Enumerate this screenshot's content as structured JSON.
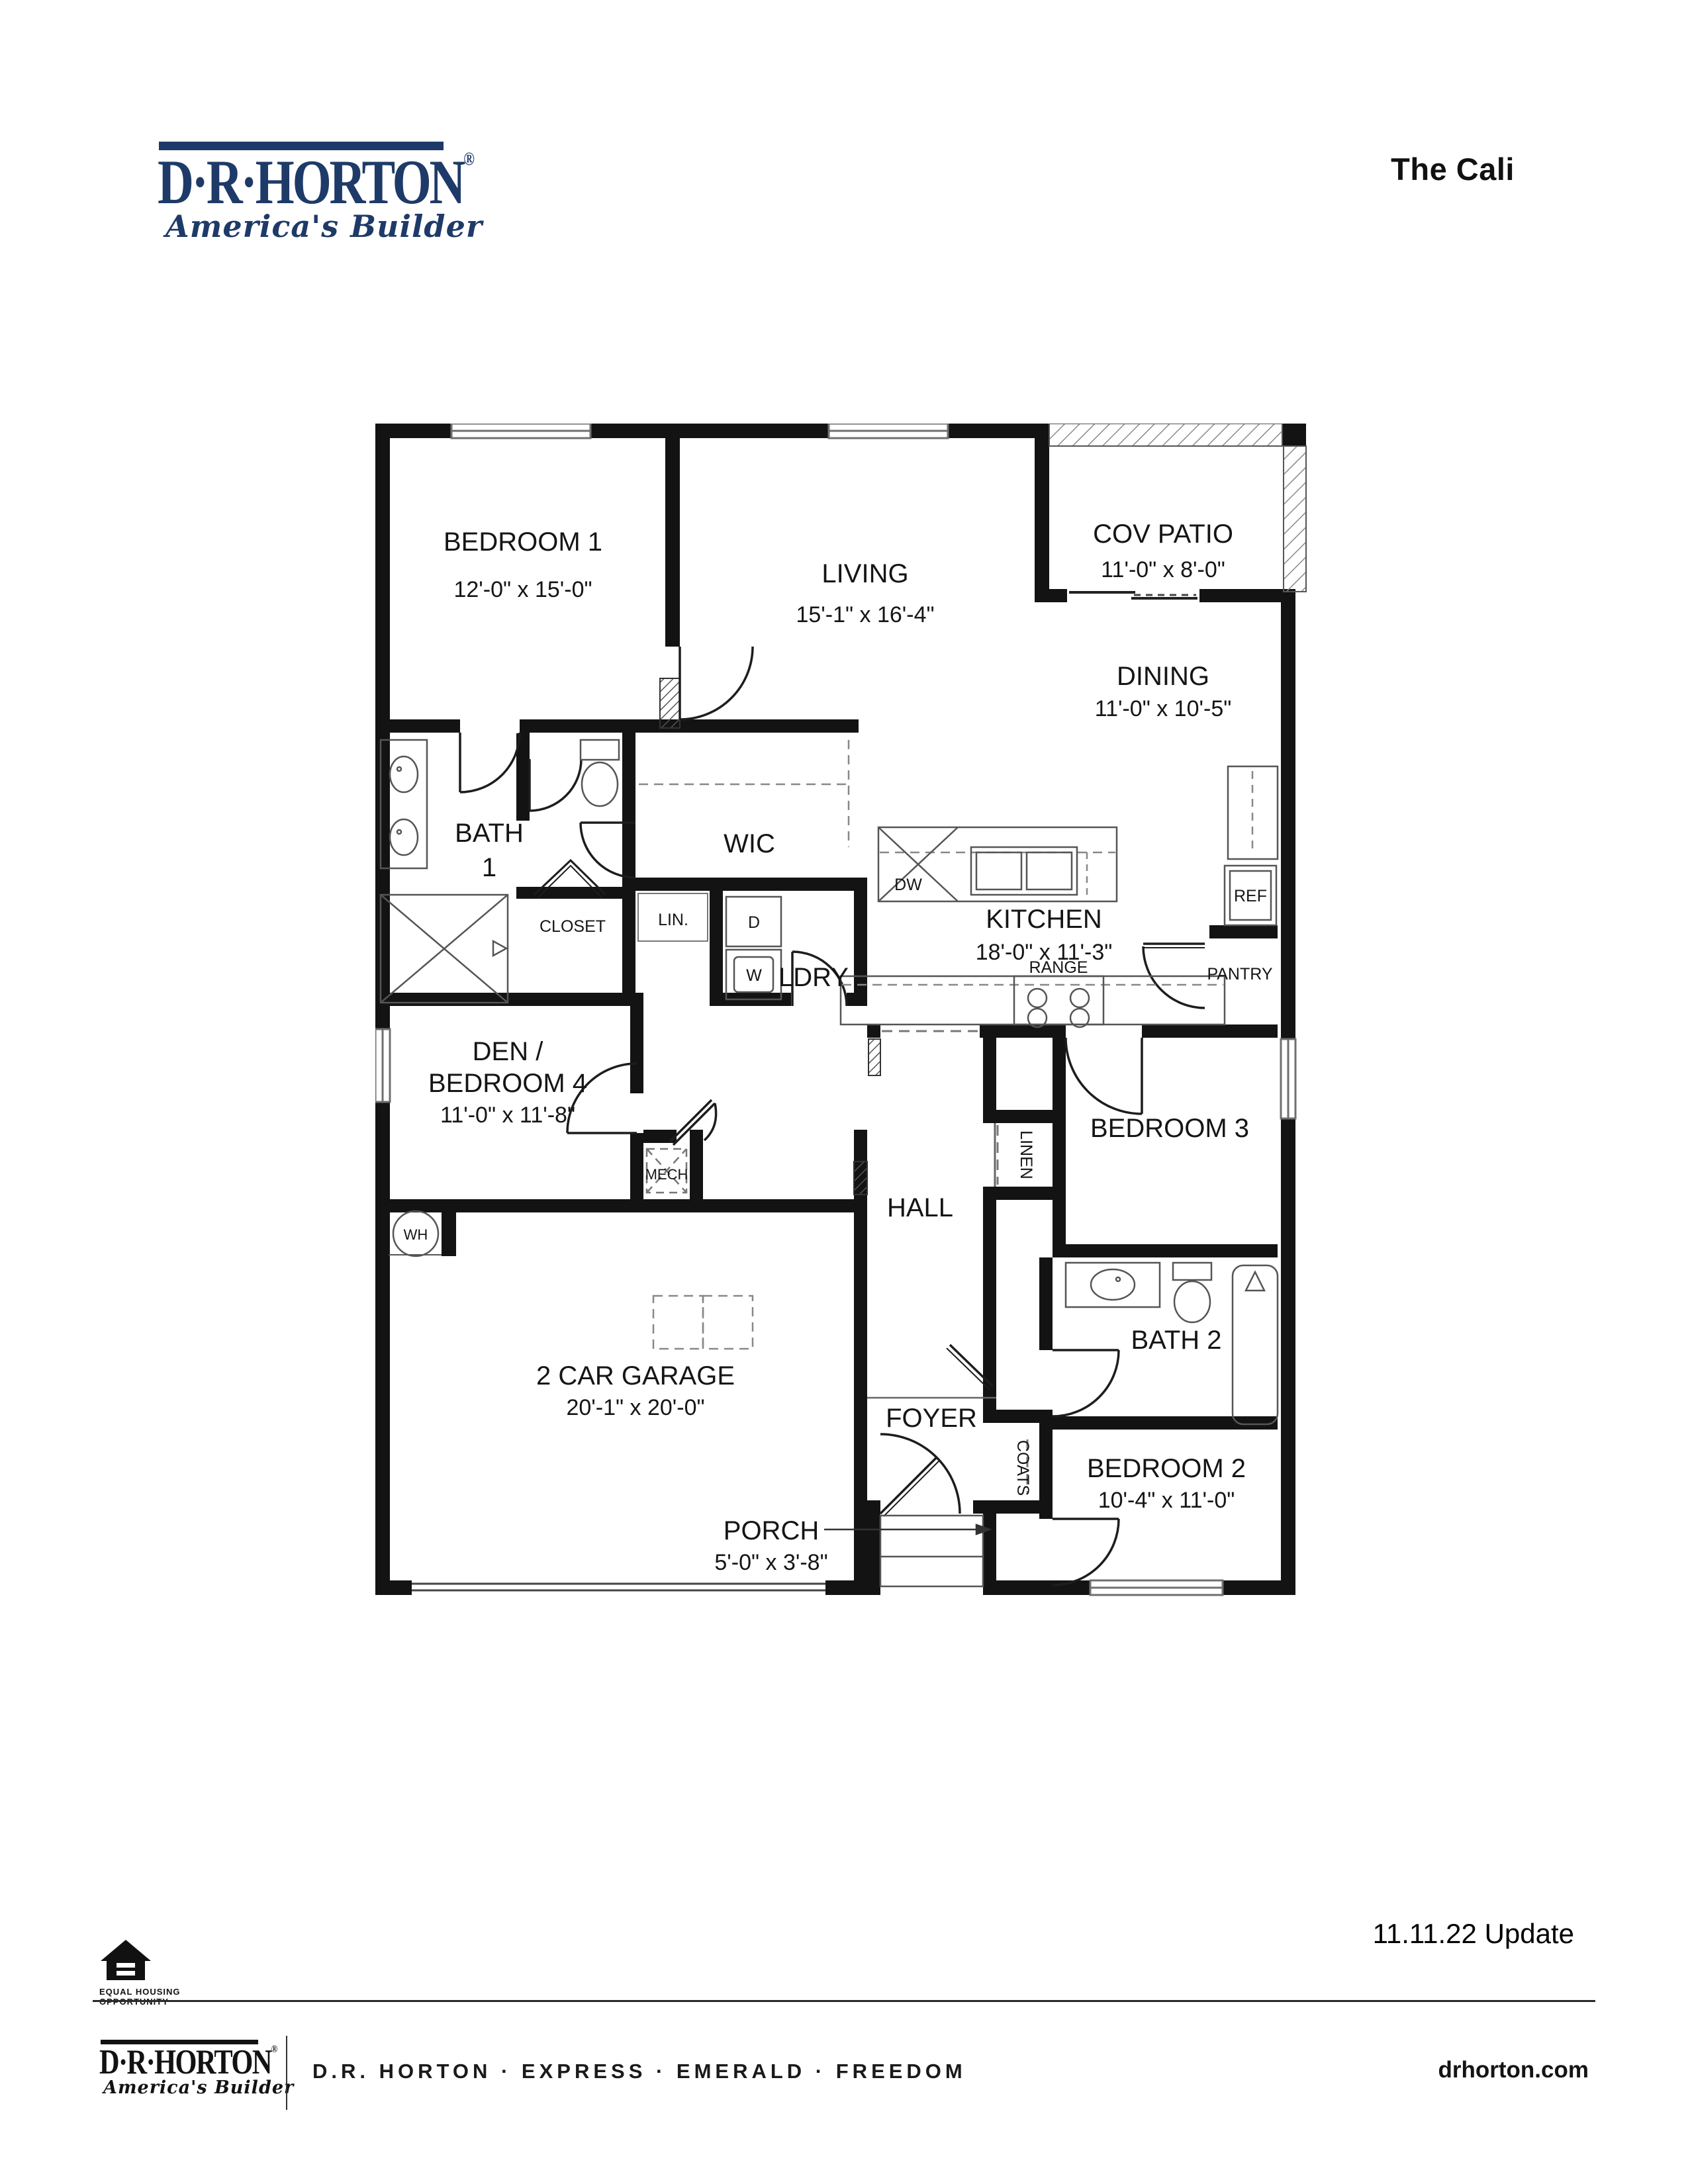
{
  "header": {
    "brand": {
      "name": "D·R·HORTON",
      "reg": "®",
      "tagline": "America's Builder"
    },
    "plan_title": "The Cali"
  },
  "plan": {
    "rooms": {
      "bedroom1": {
        "name": "BEDROOM 1",
        "dims": "12'-0\" x 15'-0\""
      },
      "living": {
        "name": "LIVING",
        "dims": "15'-1\" x 16'-4\""
      },
      "cov_patio": {
        "name": "COV PATIO",
        "dims": "11'-0\" x 8'-0\""
      },
      "dining": {
        "name": "DINING",
        "dims": "11'-0\" x 10'-5\""
      },
      "bath1": {
        "name": "BATH",
        "number": "1"
      },
      "wic": {
        "name": "WIC"
      },
      "closet": {
        "name": "CLOSET"
      },
      "ldry": {
        "name": "LDRY"
      },
      "kitchen": {
        "name": "KITCHEN",
        "dims": "18'-0\" x 11'-3\""
      },
      "den": {
        "line1": "DEN /",
        "line2": "BEDROOM 4",
        "dims": "11'-0\" x 11'-8\""
      },
      "hall": {
        "name": "HALL"
      },
      "bedroom3": {
        "name": "BEDROOM 3",
        "dims": "10'-4\" x 11'-0\""
      },
      "garage": {
        "name": "2 CAR GARAGE",
        "dims": "20'-1\" x 20'-0\""
      },
      "bath2": {
        "name": "BATH 2"
      },
      "foyer": {
        "name": "FOYER"
      },
      "bedroom2": {
        "name": "BEDROOM 2",
        "dims": "10'-4\" x 11'-0\""
      },
      "porch": {
        "name": "PORCH",
        "dims": "5'-0\" x 3'-8\""
      }
    },
    "fixtures": {
      "dw": "DW",
      "ref": "REF",
      "range": "RANGE",
      "pantry": "PANTRY",
      "dryer": "D",
      "washer": "W",
      "wh": "WH",
      "mech": "MECH",
      "lin": "LIN.",
      "linen": "LINEN",
      "coats": "COATS"
    }
  },
  "footer": {
    "update_note": "11.11.22 Update",
    "equal_housing": {
      "line1": "EQUAL HOUSING",
      "line2": "OPPORTUNITY"
    },
    "brand": {
      "name": "D·R·HORTON",
      "reg": "®",
      "tagline": "America's Builder"
    },
    "brands_line": "D.R. HORTON · EXPRESS · EMERALD · FREEDOM",
    "website": "drhorton.com"
  }
}
